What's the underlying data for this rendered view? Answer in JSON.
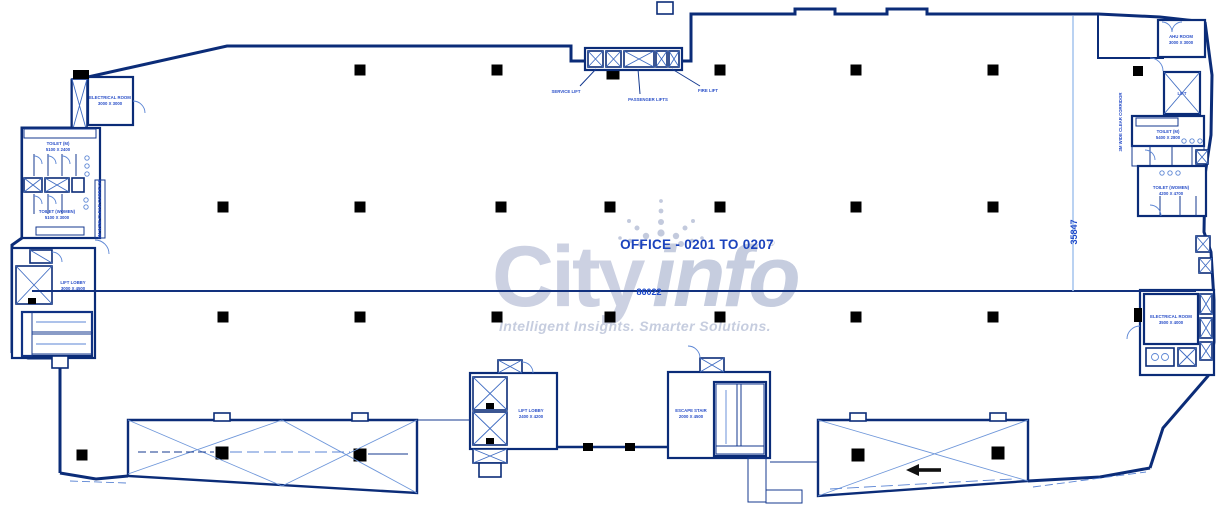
{
  "page": {
    "background": "#ffffff"
  },
  "watermark": {
    "brand_first": "City",
    "brand_second": "info",
    "registered_mark": "®",
    "tagline": "Intelligent Insights. Smarter Solutions."
  },
  "office": {
    "label": "OFFICE - 0201 TO 0207"
  },
  "dimensions": {
    "horizontal": "86022",
    "vertical": "35847"
  },
  "lifts": {
    "service": "SERVICE LIFT",
    "passenger": "PASSENGER LIFTS",
    "fire": "FIRE LIFT",
    "right_lift": "LIFT"
  },
  "corridors": {
    "left": "3M WIDE CLEAR CORRIDOR",
    "right": "3M WIDE CLEAR CORRIDOR"
  },
  "rooms": {
    "left_electrical": {
      "name": "ELECTRICAL ROOM",
      "size": "3000 X 3000"
    },
    "left_toilet_m": {
      "name": "TOILET (M)",
      "size": "5100 X 2400"
    },
    "left_toilet_w": {
      "name": "TOILET (WOMEN)",
      "size": "5100 X 3000"
    },
    "left_lift_lobby": {
      "name": "LIFT LOBBY",
      "size": "3000 X 4500"
    },
    "right_ahu": {
      "name": "AHU ROOM",
      "size": "3000 X 3000"
    },
    "right_toilet_m": {
      "name": "TOILET (M)",
      "size": "5400 X 2800"
    },
    "right_toilet_w": {
      "name": "TOILET (WOMEN)",
      "size": "4200 X 4700"
    },
    "right_electrical": {
      "name": "ELECTRICAL ROOM",
      "size": "3500 X 4000"
    },
    "bottom_lift_lobby": {
      "name": "LIFT LOBBY",
      "size": "2400 X 4200"
    },
    "escape_stair": {
      "name": "ESCAPE STAIR",
      "size": "2000 X 4500"
    }
  },
  "colors": {
    "wall": "#0b2c78",
    "detail_blue": "#5b85d4",
    "label_blue": "#2b50c8",
    "accent_label": "#1b43bd",
    "dimension_blue": "#1d49c9",
    "watermark_gray": "#ccd1e2",
    "column_black": "#000000"
  }
}
